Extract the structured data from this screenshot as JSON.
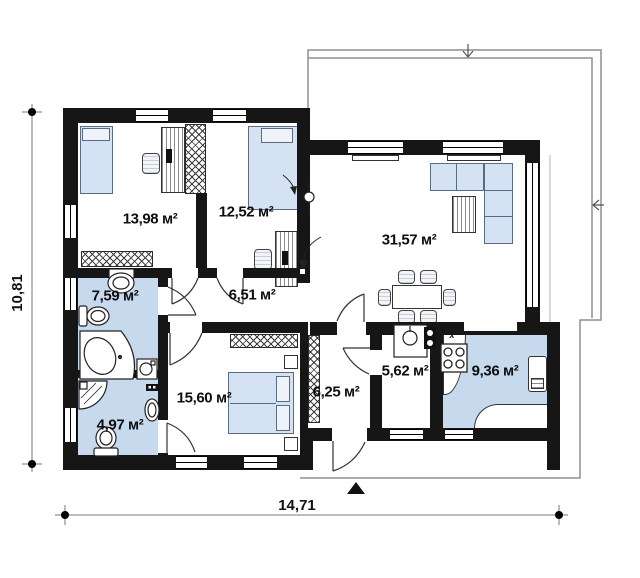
{
  "rooms": [
    {
      "key": "bedroom-1",
      "area": "13,98 м²"
    },
    {
      "key": "bedroom-2",
      "area": "12,52 м²"
    },
    {
      "key": "living-room",
      "area": "31,57 м²"
    },
    {
      "key": "bathroom",
      "area": "7,59 м²"
    },
    {
      "key": "hallway",
      "area": "6,51 м²"
    },
    {
      "key": "bedroom-3",
      "area": "15,60 м²"
    },
    {
      "key": "shower-room",
      "area": "4,97 м²"
    },
    {
      "key": "entrance-hall",
      "area": "6,25 м²"
    },
    {
      "key": "utility-room",
      "area": "5,62 м²"
    },
    {
      "key": "kitchen",
      "area": "9,36 м²"
    }
  ],
  "dimensions": {
    "overall_width_m": "14,71",
    "overall_height_m": "10,81"
  },
  "annotations": {
    "boiler_mark": "x"
  },
  "colors": {
    "wall": "#161616",
    "wet_room_floor": "#c7d9ed",
    "furniture_fill": "#d4e2f4",
    "floor": "#ffffff",
    "canopy_outline": "#8f8f8f"
  }
}
